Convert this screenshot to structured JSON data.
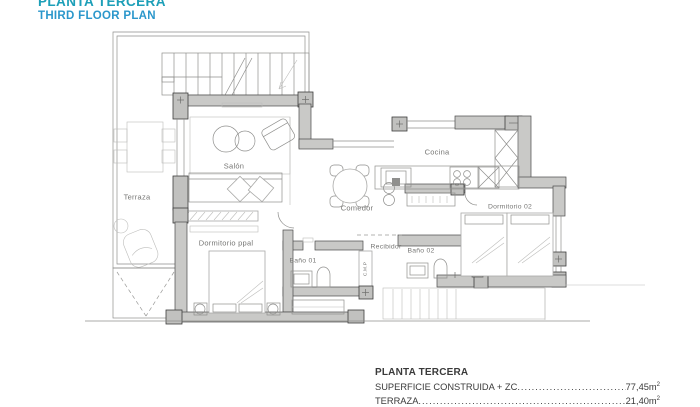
{
  "header": {
    "title_primary": "PLANTA TERCERA",
    "title_secondary": "THIRD FLOOR PLAN"
  },
  "plan": {
    "rooms": {
      "terraza": "Terraza",
      "salon": "Salón",
      "comedor": "Comedor",
      "cocina": "Cocina",
      "dormitorio02": "Dormitorio 02",
      "dormitorio_ppal": "Dormitorio ppal",
      "bano01": "Baño 01",
      "recibidor": "Recibidor",
      "bano02": "Baño 02",
      "shaft": "C.M.P"
    }
  },
  "legend": {
    "title": "PLANTA TERCERA",
    "rows": [
      {
        "label": "SUPERFICIE CONSTRUIDA + ZC",
        "dots": "............................................................",
        "value": "77,45m",
        "sup": "2"
      },
      {
        "label": "TERRAZA",
        "dots": "............................................................",
        "value": "21,40m",
        "sup": "2"
      }
    ]
  },
  "colors": {
    "accent_teal": "#1d9fb8",
    "accent_blue": "#2b97cb",
    "wall_grey": "#c9c9c7"
  }
}
